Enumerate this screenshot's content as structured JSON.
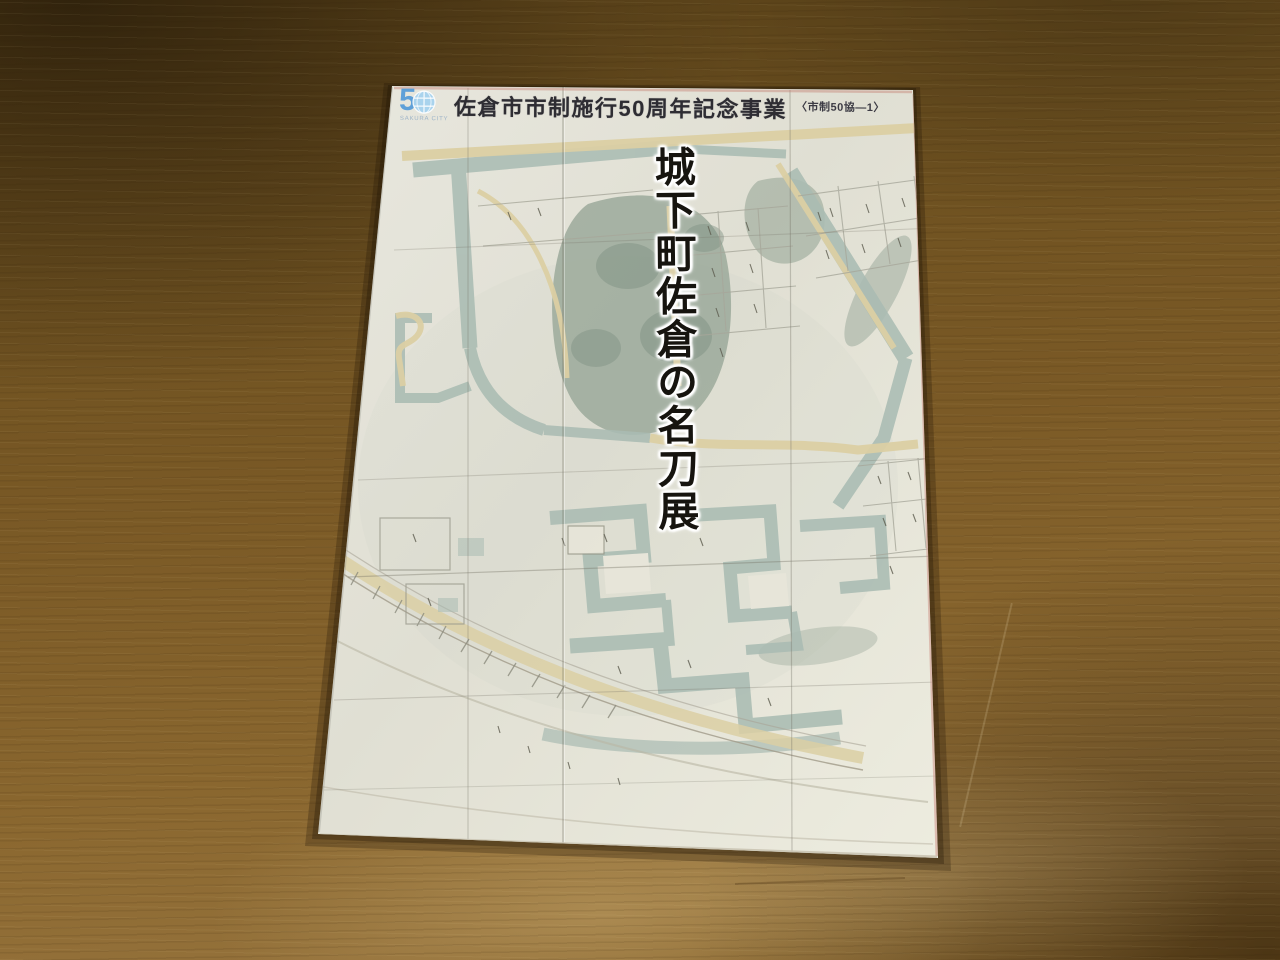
{
  "scene": {
    "type": "photograph",
    "subject": "Exhibition pamphlet with antique castle-town map cover, lying on a wooden table"
  },
  "pamphlet": {
    "header": {
      "logo_five": "5",
      "logo_subtext": "SAKURA CITY",
      "event_title": "佐倉市市制施行50周年記念事業",
      "code_label": "〈市制50協―1〉"
    },
    "cover_title": "城下町佐倉の名刀展"
  },
  "colors": {
    "wood_dark": "#5e451a",
    "wood_mid": "#7b5a26",
    "wood_light": "#94713a",
    "paper": "#e4e3d7",
    "moat_wash": "#aabcb3",
    "vegetation": "#93a394",
    "road_beige": "#dccfa4",
    "title_ink": "#16140f",
    "header_ink": "#2e2d33",
    "logo_blue": "#5ea0d8"
  }
}
